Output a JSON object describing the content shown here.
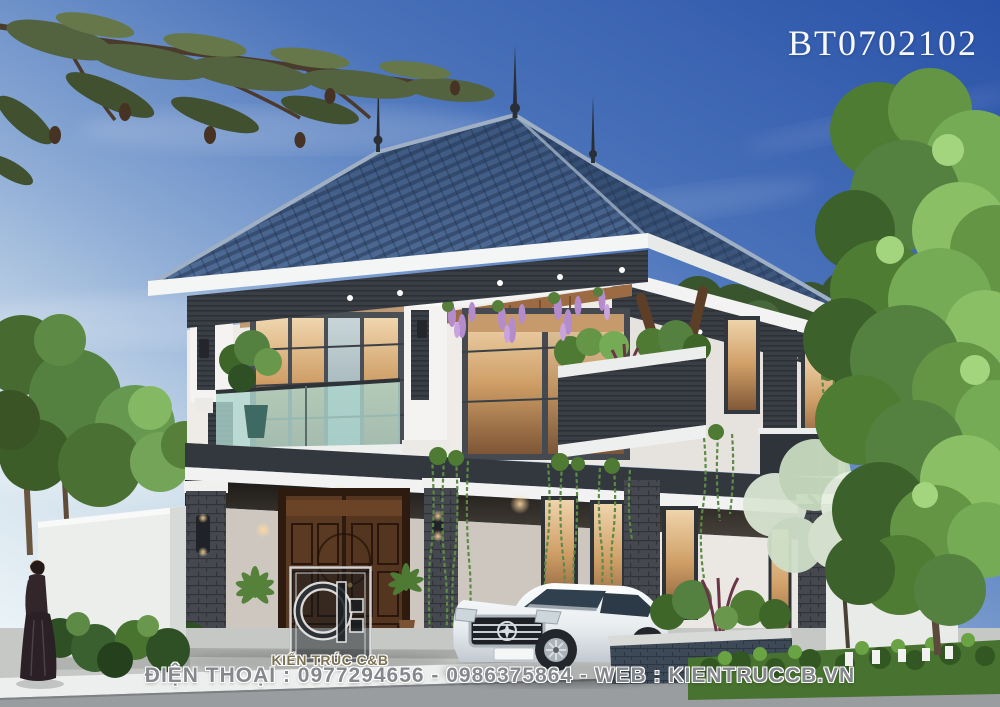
{
  "watermarks": {
    "code": "BT0702102",
    "brand": "KIẾN TRÚC C&B",
    "contact": "ĐIỆN THOẠI : 0977294656 - 0986375864 - WEB : KIENTRUCCB.VN"
  },
  "palette": {
    "sky_top": "#2a52a8",
    "sky_horizon": "#e9f2f6",
    "roof_blue": "#33517c",
    "roof_light": "#52729e",
    "fascia_white": "#f4f5f5",
    "accent_charcoal": "#3a3f45",
    "wall_white": "#f0eeea",
    "door_wood": "#4e3018",
    "warm_glass": "#e3bc8a",
    "balcony_glass": "#aed6cd",
    "foliage_green": "#5e8b41",
    "car_white": "#f0f3f5",
    "hedge_green": "#4a7530",
    "road_grey": "#9b9ea0",
    "watermark_grey": "#84878b",
    "brand_olive": "#7b7252"
  }
}
